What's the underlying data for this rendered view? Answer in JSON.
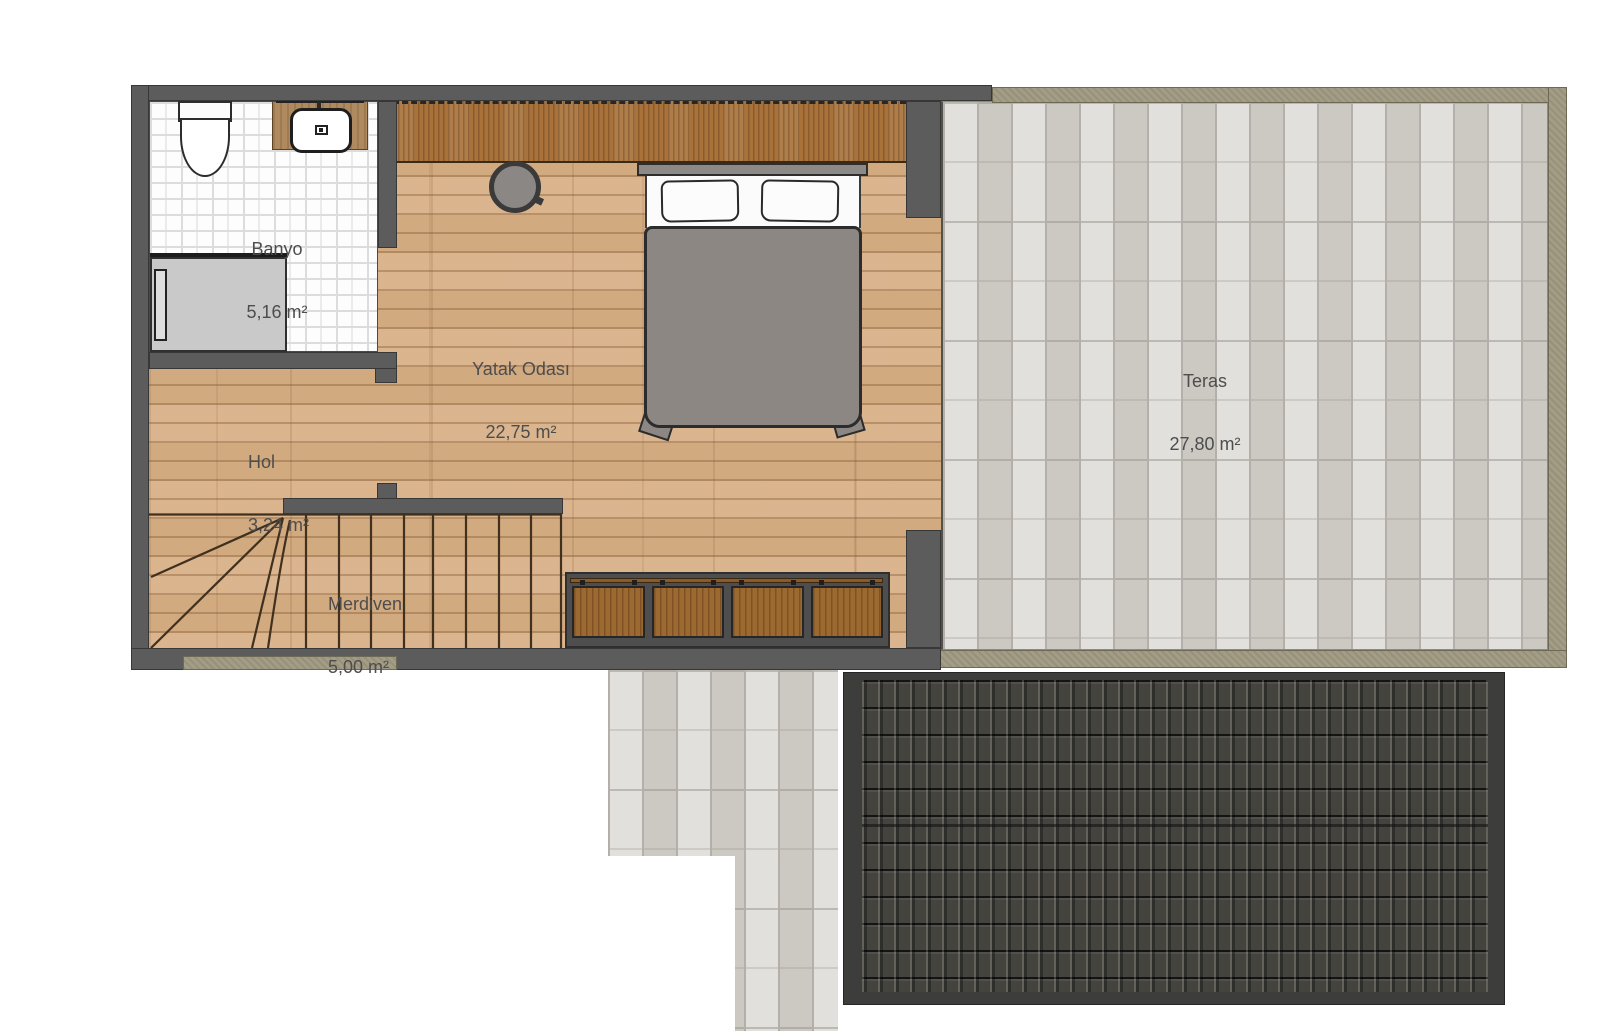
{
  "plan": {
    "type": "floor-plan",
    "floor": "upper-floor",
    "rooms": {
      "banyo": {
        "name": "Banyo",
        "area": "5,16 m²"
      },
      "yatak": {
        "name": "Yatak Odası",
        "area": "22,75 m²"
      },
      "hol": {
        "name": "Hol",
        "area": "3,24 m²"
      },
      "merdiven": {
        "name": "Merdiven",
        "area": "5,00 m²"
      },
      "teras": {
        "name": "Teras",
        "area": "27,80 m²"
      }
    },
    "palette": {
      "wall_gray": "#5c5c5c",
      "wood_floor": "#d8b087",
      "closet_brown": "#a8723a",
      "cabinet_brown": "#9c6930",
      "bath_tile_white": "#fdfdfd",
      "terrace_tile": "#d6d3cd",
      "curb_tan": "#a49d85",
      "roof_dark": "#44433e",
      "shower_gray": "#c9c9c9",
      "bed_gray": "#8d8783",
      "label_text": "#4d4d4d"
    }
  }
}
